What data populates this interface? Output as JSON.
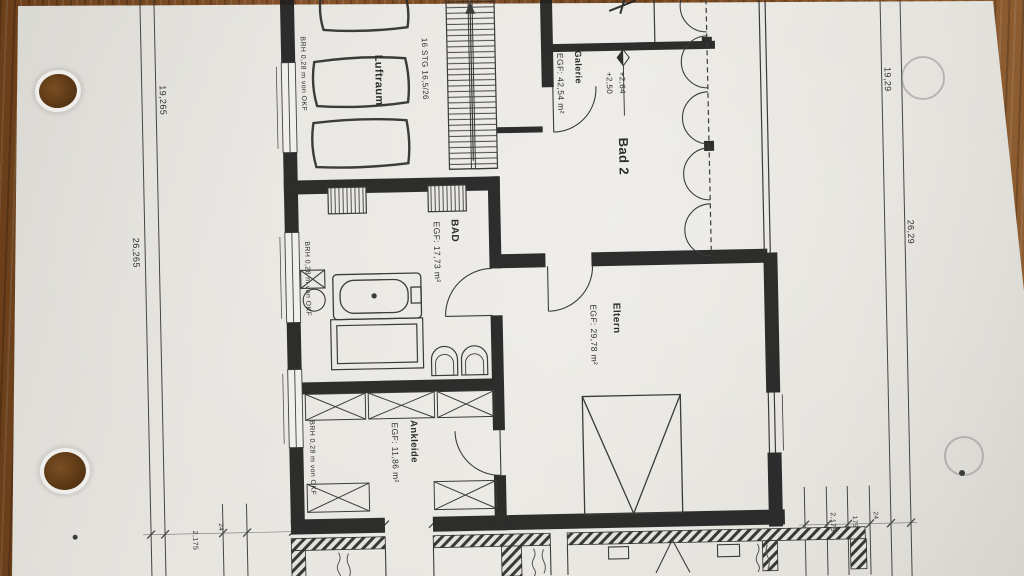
{
  "scene": {
    "description": "Photograph of an architectural floor plan (Obergeschoss) lying on a wooden desk, drawing rotated 90 degrees",
    "paper_color": "#e8e6e1",
    "wood_color": "#7a4a20",
    "ink_color": "#222222"
  },
  "rooms": {
    "luftraum": {
      "label": "Luftraum"
    },
    "galerie": {
      "label": "Galerie",
      "area": "EGF: 42,54 m²"
    },
    "bad2": {
      "label": "Bad 2"
    },
    "bad": {
      "label": "BAD",
      "area": "EGF: 17,73 m²"
    },
    "eltern": {
      "label": "Eltern",
      "area": "EGF: 29,78 m²"
    },
    "ankleide": {
      "label": "Ankleide",
      "area": "EGF: 11,86 m²"
    }
  },
  "annotations": {
    "stairs": "16 STG 16,5/26",
    "level_upper": "+2,64",
    "level_lower": "+2,50",
    "window_sill": "BRH 0,28 m von OKF"
  },
  "dimensions": {
    "left_inner": "19,265",
    "left_outer": "26,265",
    "right_inner": "19,29",
    "right_outer": "26,29",
    "bottom_left_a": "2,175",
    "bottom_left_b": "24",
    "bottom_right_a": "2,175",
    "bottom_right_b": "175",
    "bottom_right_c": "24"
  }
}
